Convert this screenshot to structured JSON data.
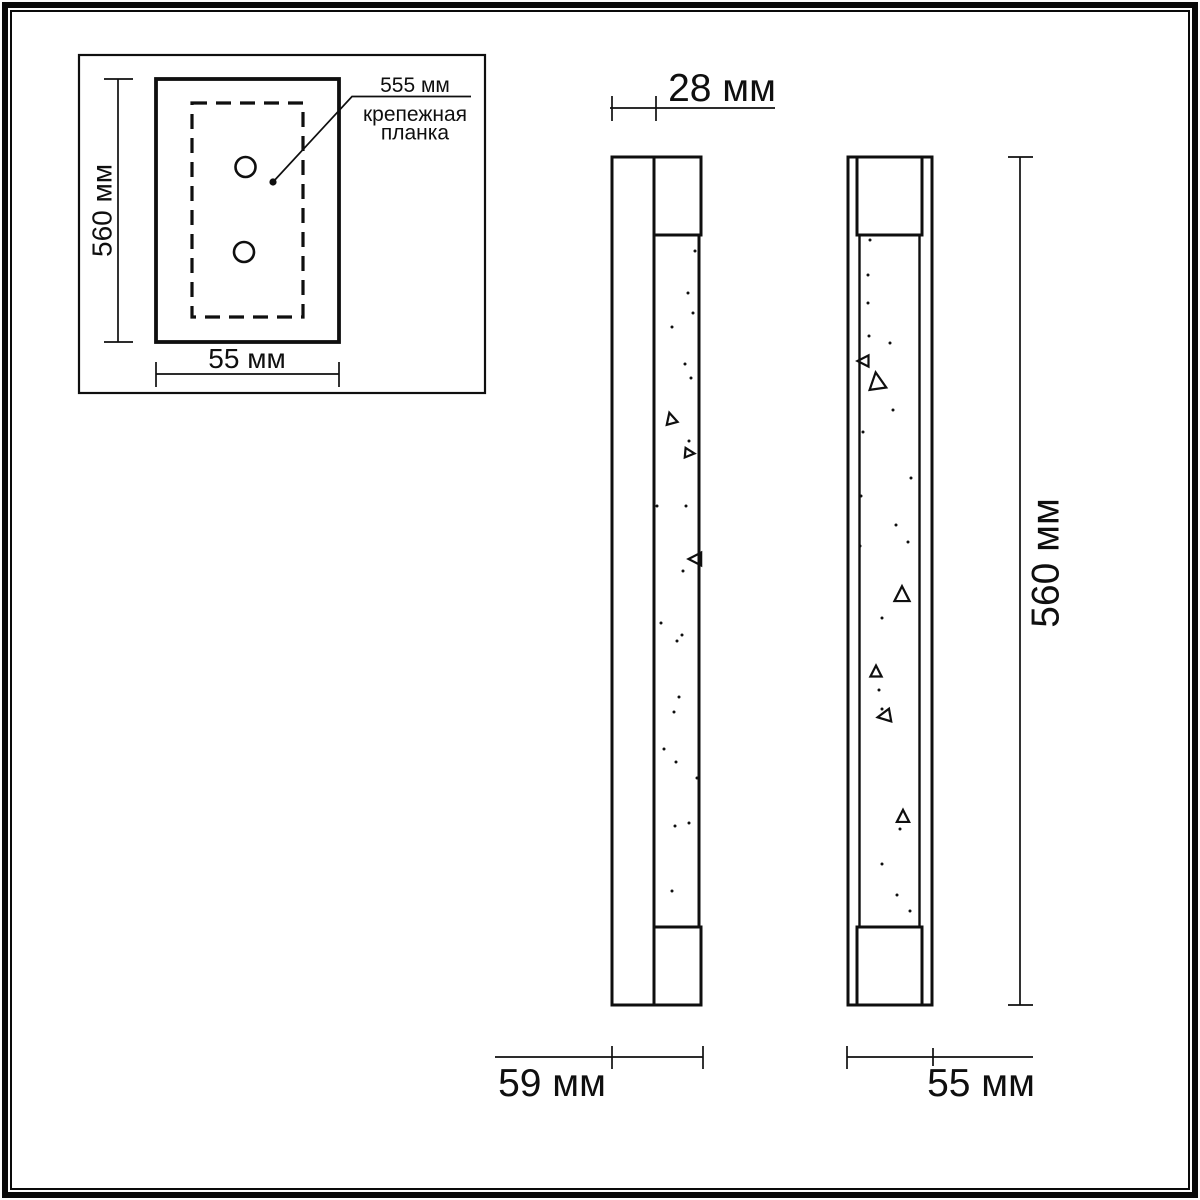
{
  "colors": {
    "background": "#ffffff",
    "line": "#0f0f0f"
  },
  "inset": {
    "height_label": "560 мм",
    "width_label": "55 мм",
    "leader_label": "555 мм",
    "leader_caption_line1": "крепежная",
    "leader_caption_line2": "планка"
  },
  "side_view": {
    "depth_label": "28 мм",
    "width_label": "59 мм"
  },
  "front_view": {
    "height_label": "560 мм",
    "width_label": "55 мм"
  }
}
